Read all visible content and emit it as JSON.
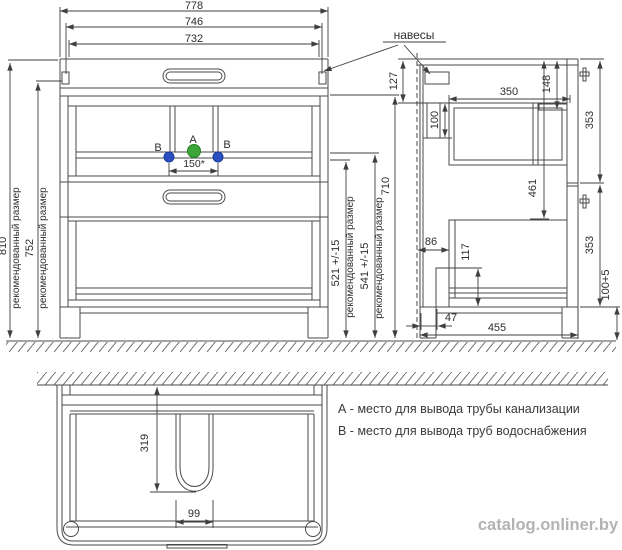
{
  "labels": {
    "hangers": "навесы",
    "recommended": "рекомендованный размер",
    "point_a": "A",
    "point_b": "B"
  },
  "colors": {
    "line": "#4a4a4a",
    "text": "#2e2e2e",
    "point_a_fill": "#3da639",
    "point_a_stroke": "#23801f",
    "point_b_fill": "#2b4fc0",
    "point_b_stroke": "#1a3a9e",
    "watermark": "#b3b3b3"
  },
  "front": {
    "dim_778": "778",
    "dim_746": "746",
    "dim_732": "732",
    "dim_810": "810",
    "dim_752": "752",
    "dim_521": "521 +/-15",
    "dim_541": "541 +/-15",
    "dim_710": "710",
    "dim_150": "150*"
  },
  "side": {
    "dim_127": "127",
    "dim_100": "100",
    "dim_350": "350",
    "dim_148": "148",
    "dim_353_upper": "353",
    "dim_461": "461",
    "dim_86": "86",
    "dim_117": "117",
    "dim_353_lower": "353",
    "dim_47": "47",
    "dim_455": "455",
    "dim_100_5": "100+5"
  },
  "bottom": {
    "dim_319": "319",
    "dim_99": "99"
  },
  "legend": {
    "line_a": "А - место для вывода трубы канализации",
    "line_b": "В - место для вывода труб водоснабжения"
  },
  "watermark": "catalog.onliner.by"
}
